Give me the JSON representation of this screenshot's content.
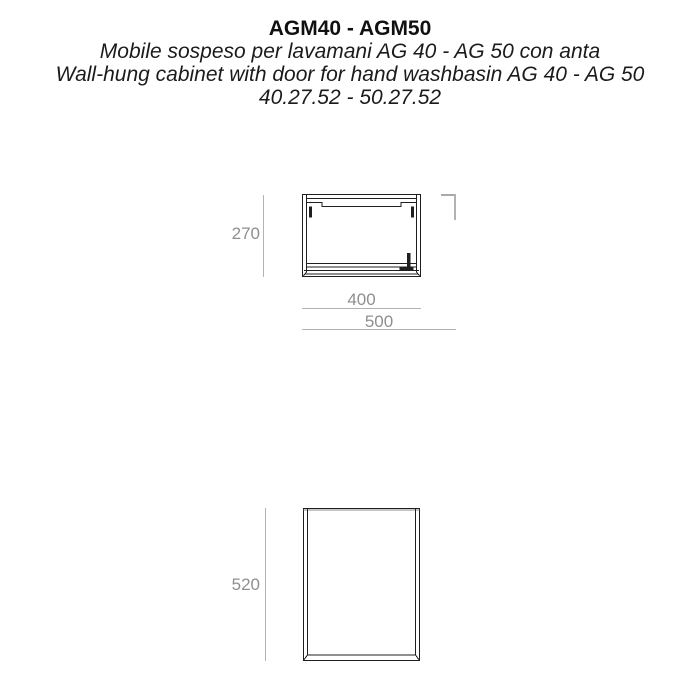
{
  "header": {
    "title": "AGM40 - AGM50",
    "subtitle_it": "Mobile sospeso per lavamani AG 40 - AG 50 con anta",
    "subtitle_en": "Wall-hung cabinet with door for hand washbasin AG 40 - AG 50",
    "product_codes": "40.27.52 - 50.27.52"
  },
  "colors": {
    "drawing_line": "#1f1f1f",
    "dimension_text": "#8f8f8f",
    "dimension_line": "#b2b2b2"
  },
  "top_view": {
    "description": "plan view of wall-hung cabinet with door hinge detail",
    "depth_mm": "270",
    "width_agm40_mm": "400",
    "width_agm50_mm": "500"
  },
  "front_view": {
    "description": "front view of cabinet door panel",
    "height_mm": "520"
  }
}
